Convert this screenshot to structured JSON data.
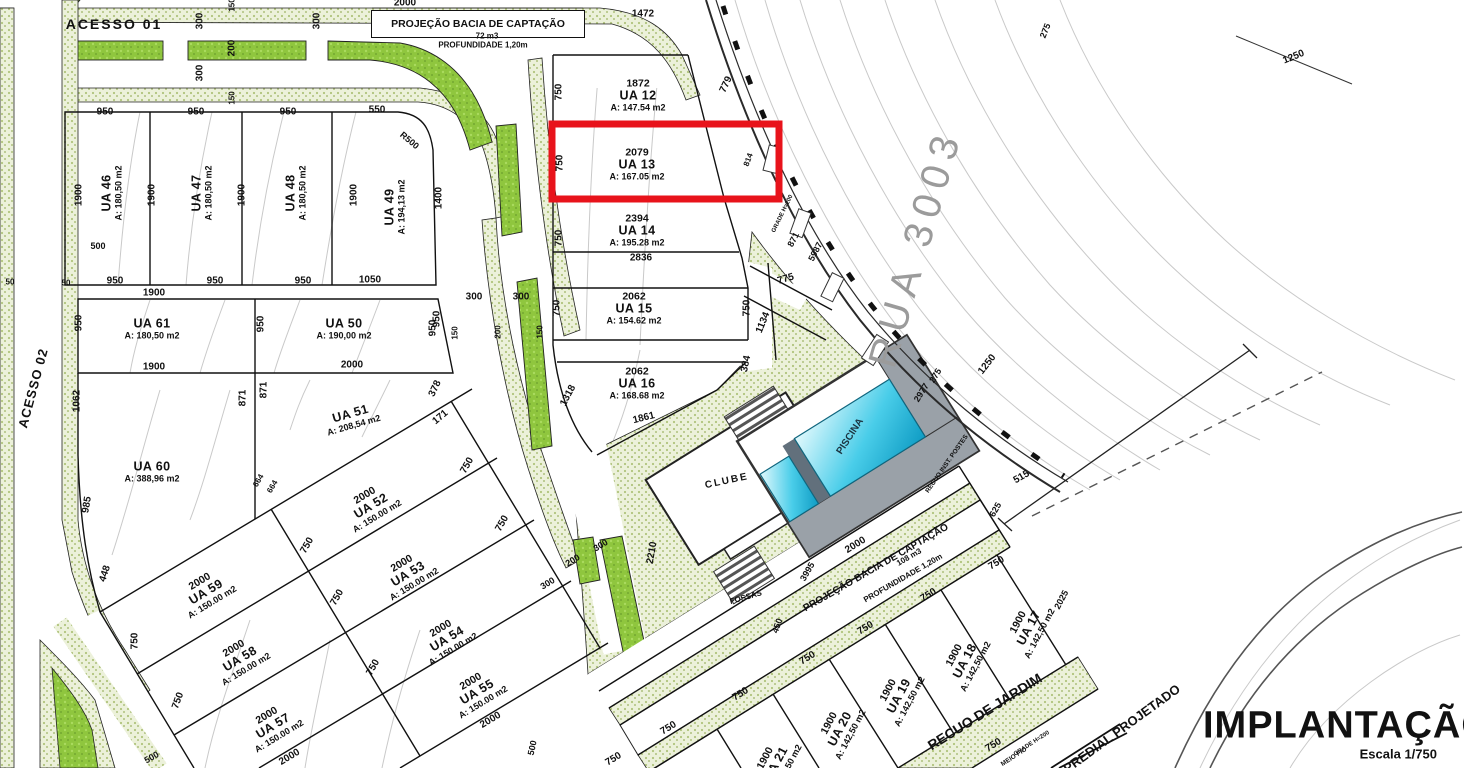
{
  "title": {
    "main": "IMPLANTAÇÃO",
    "scale": "Escala 1/750"
  },
  "roads": {
    "acesso1": "ACESSO 01",
    "acesso2": "ACESSO 02",
    "rua": "RUA 3003"
  },
  "basins": [
    {
      "title": "PROJEÇÃO BACIA DE CAPTAÇÃO",
      "volume": "72 m3",
      "depth": "PROFUNDIDADE 1,20m"
    },
    {
      "title": "PROJEÇÃO BACIA DE CAPTAÇÃO",
      "volume": "108 m3",
      "depth": "PROFUNDIDADE 1,20m"
    }
  ],
  "highlight": {
    "lot": "UA 13",
    "color": "#e8131b"
  },
  "colors": {
    "speckle_base": "#ecf1da",
    "speckle_dot": "#a9bf72",
    "island_green": "#8fc63e",
    "pool_light": "#e2f9fd",
    "pool_dark": "#0f9cc4",
    "deck_gray": "#9aa1a8",
    "contour": "#c9c9c9",
    "line": "#111111",
    "highlight": "#e8131b",
    "rua_text": "#9b9b9b"
  },
  "lots": [
    {
      "name": "UA 46",
      "area": "A: 180,50 m2",
      "x": 112,
      "y": 193,
      "r": -90
    },
    {
      "name": "UA 47",
      "area": "A: 180,50 m2",
      "x": 202,
      "y": 193,
      "r": -90
    },
    {
      "name": "UA 48",
      "area": "A: 180,50 m2",
      "x": 296,
      "y": 193,
      "r": -90
    },
    {
      "name": "UA 49",
      "area": "A: 194,13 m2",
      "x": 395,
      "y": 207,
      "r": -90
    },
    {
      "name": "UA 61",
      "area": "A: 180,50 m2",
      "x": 152,
      "y": 329,
      "r": 0
    },
    {
      "name": "UA 50",
      "area": "A: 190,00 m2",
      "x": 344,
      "y": 329,
      "r": 0
    },
    {
      "name": "UA 51",
      "area": "A: 208,54 m2",
      "x": 352,
      "y": 419,
      "r": -16
    },
    {
      "name": "UA 60",
      "area": "A: 388,96 m2",
      "x": 152,
      "y": 472,
      "r": 0
    },
    {
      "pre": "1872",
      "name": "UA 12",
      "area": "A: 147.54 m2",
      "x": 638,
      "y": 96,
      "r": 0
    },
    {
      "pre": "2079",
      "name": "UA 13",
      "area": "A: 167.05 m2",
      "x": 637,
      "y": 165,
      "r": 0
    },
    {
      "pre": "2394",
      "name": "UA 14",
      "area": "A: 195.28 m2",
      "x": 637,
      "y": 231,
      "r": 0
    },
    {
      "pre": "2062",
      "name": "UA 15",
      "area": "A: 154.62 m2",
      "x": 634,
      "y": 309,
      "r": 0
    },
    {
      "pre": "2062",
      "name": "UA 16",
      "area": "A: 168.68 m2",
      "x": 637,
      "y": 384,
      "r": 0
    },
    {
      "pre": "2000",
      "name": "UA 52",
      "area": "A: 150.00 m2",
      "x": 371,
      "y": 506,
      "r": -31
    },
    {
      "pre": "2000",
      "name": "UA 53",
      "area": "A: 150.00 m2",
      "x": 408,
      "y": 574,
      "r": -31
    },
    {
      "pre": "2000",
      "name": "UA 54",
      "area": "A: 150.00 m2",
      "x": 447,
      "y": 639,
      "r": -31
    },
    {
      "pre": "2000",
      "name": "UA 55",
      "area": "A: 150.00 m2",
      "x": 477,
      "y": 692,
      "r": -31
    },
    {
      "pre": "2000",
      "name": "UA 59",
      "area": "A: 150.00 m2",
      "x": 206,
      "y": 592,
      "r": -31
    },
    {
      "pre": "2000",
      "name": "UA 58",
      "area": "A: 150.00 m2",
      "x": 240,
      "y": 659,
      "r": -31
    },
    {
      "pre": "2000",
      "name": "UA 57",
      "area": "A: 150.00 m2",
      "x": 273,
      "y": 726,
      "r": -31
    },
    {
      "pre": "1900",
      "name": "UA 17",
      "area": "A: 142,50 m2",
      "x": 1029,
      "y": 628,
      "r": -62
    },
    {
      "pre": "1900",
      "name": "UA 18",
      "area": "A: 142,50 m2",
      "x": 965,
      "y": 661,
      "r": -62
    },
    {
      "pre": "1900",
      "name": "UA 19",
      "area": "A: 142,50 m2",
      "x": 899,
      "y": 696,
      "r": -62
    },
    {
      "pre": "1900",
      "name": "UA 20",
      "area": "A: 142,50 m2",
      "x": 840,
      "y": 729,
      "r": -62
    },
    {
      "pre": "1900",
      "name": "UA 21",
      "area": "A: 142,50 m2",
      "x": 776,
      "y": 764,
      "r": -62
    }
  ],
  "dims": [
    {
      "t": "2000",
      "x": 405,
      "y": 4,
      "r": 0
    },
    {
      "t": "150",
      "x": 233,
      "y": 5,
      "r": -90,
      "s": 8
    },
    {
      "t": "300",
      "x": 201,
      "y": 21,
      "r": -90
    },
    {
      "t": "200",
      "x": 233,
      "y": 48,
      "r": -90
    },
    {
      "t": "300",
      "x": 201,
      "y": 73,
      "r": -90
    },
    {
      "t": "150",
      "x": 233,
      "y": 98,
      "r": -90,
      "s": 8
    },
    {
      "t": "300",
      "x": 318,
      "y": 21,
      "r": -90
    },
    {
      "t": "1472",
      "x": 643,
      "y": 15,
      "r": 0
    },
    {
      "t": "950",
      "x": 105,
      "y": 113,
      "r": 0
    },
    {
      "t": "950",
      "x": 196,
      "y": 113,
      "r": 0
    },
    {
      "t": "950",
      "x": 288,
      "y": 113,
      "r": 0
    },
    {
      "t": "550",
      "x": 377,
      "y": 111,
      "r": 0
    },
    {
      "t": "1900",
      "x": 80,
      "y": 195,
      "r": -90
    },
    {
      "t": "1900",
      "x": 153,
      "y": 195,
      "r": -90
    },
    {
      "t": "1900",
      "x": 243,
      "y": 195,
      "r": -90
    },
    {
      "t": "1900",
      "x": 355,
      "y": 195,
      "r": -90
    },
    {
      "t": "1400",
      "x": 440,
      "y": 198,
      "r": -90
    },
    {
      "t": "500",
      "x": 98,
      "y": 247,
      "r": 0,
      "s": 9
    },
    {
      "t": "50",
      "x": 10,
      "y": 283,
      "r": 0,
      "s": 8
    },
    {
      "t": "50",
      "x": 66,
      "y": 284,
      "r": 0,
      "s": 8
    },
    {
      "t": "950",
      "x": 115,
      "y": 282,
      "r": 0
    },
    {
      "t": "950",
      "x": 215,
      "y": 282,
      "r": 0
    },
    {
      "t": "950",
      "x": 303,
      "y": 282,
      "r": 0
    },
    {
      "t": "1050",
      "x": 370,
      "y": 281,
      "r": 0
    },
    {
      "t": "1900",
      "x": 154,
      "y": 294,
      "r": 0
    },
    {
      "t": "950",
      "x": 80,
      "y": 323,
      "r": -90
    },
    {
      "t": "950",
      "x": 262,
      "y": 324,
      "r": -90
    },
    {
      "t": "950",
      "x": 434,
      "y": 328,
      "r": -90
    },
    {
      "t": "1900",
      "x": 154,
      "y": 368,
      "r": 0
    },
    {
      "t": "2000",
      "x": 352,
      "y": 366,
      "r": 0
    },
    {
      "t": "1062",
      "x": 78,
      "y": 401,
      "r": -90
    },
    {
      "t": "871",
      "x": 244,
      "y": 398,
      "r": -90
    },
    {
      "t": "871",
      "x": 265,
      "y": 390,
      "r": -90
    },
    {
      "t": "378",
      "x": 436,
      "y": 389,
      "r": -65
    },
    {
      "t": "171",
      "x": 441,
      "y": 418,
      "r": -40
    },
    {
      "t": "985",
      "x": 88,
      "y": 505,
      "r": -80
    },
    {
      "t": "448",
      "x": 106,
      "y": 574,
      "r": -72
    },
    {
      "t": "664",
      "x": 259,
      "y": 481,
      "r": -60,
      "s": 8
    },
    {
      "t": "664",
      "x": 273,
      "y": 487,
      "r": -60,
      "s": 8
    },
    {
      "t": "750",
      "x": 560,
      "y": 92,
      "r": -90
    },
    {
      "t": "750",
      "x": 561,
      "y": 163,
      "r": -90
    },
    {
      "t": "750",
      "x": 560,
      "y": 238,
      "r": -90
    },
    {
      "t": "750",
      "x": 558,
      "y": 308,
      "r": -90
    },
    {
      "t": "750",
      "x": 748,
      "y": 308,
      "r": -90
    },
    {
      "t": "2836",
      "x": 641,
      "y": 259,
      "r": 0
    },
    {
      "t": "775",
      "x": 786,
      "y": 280,
      "r": -16
    },
    {
      "t": "1134",
      "x": 764,
      "y": 323,
      "r": -68
    },
    {
      "t": "384",
      "x": 747,
      "y": 364,
      "r": -78
    },
    {
      "t": "1318",
      "x": 569,
      "y": 396,
      "r": -62
    },
    {
      "t": "1861",
      "x": 644,
      "y": 419,
      "r": -14
    },
    {
      "t": "779",
      "x": 727,
      "y": 85,
      "r": -65
    },
    {
      "t": "814",
      "x": 749,
      "y": 160,
      "r": -70,
      "s": 8
    },
    {
      "t": "871",
      "x": 794,
      "y": 240,
      "r": -62,
      "s": 9
    },
    {
      "t": "5987",
      "x": 816,
      "y": 252,
      "r": -62,
      "s": 9
    },
    {
      "t": "2977",
      "x": 922,
      "y": 393,
      "r": -58,
      "s": 9
    },
    {
      "t": "275",
      "x": 936,
      "y": 376,
      "r": -58,
      "s": 9
    },
    {
      "t": "1250",
      "x": 988,
      "y": 365,
      "r": -52
    },
    {
      "t": "275",
      "x": 1046,
      "y": 31,
      "r": -68,
      "s": 9
    },
    {
      "t": "1250",
      "x": 1294,
      "y": 58,
      "r": -22
    },
    {
      "t": "515",
      "x": 1022,
      "y": 478,
      "r": -30
    },
    {
      "t": "625",
      "x": 996,
      "y": 510,
      "r": -60,
      "s": 9
    },
    {
      "t": "2025",
      "x": 1062,
      "y": 600,
      "r": -62,
      "s": 9
    },
    {
      "t": "2000",
      "x": 856,
      "y": 546,
      "r": -32
    },
    {
      "t": "3995",
      "x": 808,
      "y": 572,
      "r": -60,
      "s": 9
    },
    {
      "t": "450",
      "x": 778,
      "y": 626,
      "r": -70,
      "s": 9
    },
    {
      "t": "300",
      "x": 548,
      "y": 584,
      "r": -32,
      "s": 9
    },
    {
      "t": "200",
      "x": 573,
      "y": 561,
      "r": -32,
      "s": 9
    },
    {
      "t": "300",
      "x": 601,
      "y": 546,
      "r": -32,
      "s": 9
    },
    {
      "t": "2210",
      "x": 653,
      "y": 553,
      "r": -80
    },
    {
      "t": "300",
      "x": 474,
      "y": 298,
      "r": 0
    },
    {
      "t": "300",
      "x": 521,
      "y": 298,
      "r": 0
    },
    {
      "t": "150",
      "x": 456,
      "y": 333,
      "r": -90,
      "s": 8
    },
    {
      "t": "200",
      "x": 499,
      "y": 332,
      "r": -90,
      "s": 8
    },
    {
      "t": "150",
      "x": 541,
      "y": 332,
      "r": -90,
      "s": 8
    },
    {
      "t": "950",
      "x": 438,
      "y": 319,
      "r": -90
    },
    {
      "t": "750",
      "x": 468,
      "y": 466,
      "r": -60
    },
    {
      "t": "750",
      "x": 503,
      "y": 524,
      "r": -60
    },
    {
      "t": "750",
      "x": 308,
      "y": 546,
      "r": -60
    },
    {
      "t": "750",
      "x": 338,
      "y": 598,
      "r": -60
    },
    {
      "t": "750",
      "x": 136,
      "y": 641,
      "r": -90
    },
    {
      "t": "750",
      "x": 179,
      "y": 701,
      "r": -70
    },
    {
      "t": "750",
      "x": 374,
      "y": 668,
      "r": -60
    },
    {
      "t": "500",
      "x": 152,
      "y": 758,
      "r": -30,
      "s": 9
    },
    {
      "t": "500",
      "x": 533,
      "y": 748,
      "r": -78,
      "s": 9
    },
    {
      "t": "750",
      "x": 997,
      "y": 564,
      "r": -32
    },
    {
      "t": "750",
      "x": 929,
      "y": 596,
      "r": -32
    },
    {
      "t": "750",
      "x": 866,
      "y": 629,
      "r": -32
    },
    {
      "t": "750",
      "x": 808,
      "y": 659,
      "r": -32
    },
    {
      "t": "750",
      "x": 741,
      "y": 695,
      "r": -32
    },
    {
      "t": "750",
      "x": 669,
      "y": 729,
      "r": -32
    },
    {
      "t": "750",
      "x": 614,
      "y": 760,
      "r": -32
    },
    {
      "t": "750",
      "x": 994,
      "y": 746,
      "r": -32
    },
    {
      "t": "2000",
      "x": 290,
      "y": 758,
      "r": -31
    },
    {
      "t": "2000",
      "x": 491,
      "y": 721,
      "r": -31
    }
  ],
  "notes": [
    {
      "n": "clube-label",
      "t": "CLUBE",
      "x": 727,
      "y": 482,
      "r": -12,
      "s": 10,
      "ls": 2
    },
    {
      "n": "piscina-label",
      "t": "PISCINA",
      "x": 851,
      "y": 437,
      "r": -57,
      "s": 10,
      "c": "#1b3440"
    },
    {
      "n": "fossas-label",
      "t": "FOSSAS",
      "x": 746,
      "y": 598,
      "r": -16,
      "s": 8
    },
    {
      "n": "recuo-jardim-label",
      "t": "RECUO DE JARDIM",
      "x": 985,
      "y": 712,
      "r": -32,
      "s": 14
    },
    {
      "n": "recuo-postes-label",
      "t": "RECUO INST. POSTES",
      "x": 947,
      "y": 464,
      "r": -55,
      "s": 6.5
    },
    {
      "n": "meio-fio-label",
      "t": "MEIO FIO",
      "x": 1014,
      "y": 757,
      "r": -33,
      "s": 6.5
    },
    {
      "n": "grade-label-1",
      "t": "GRADE H=200",
      "x": 1032,
      "y": 744,
      "r": -33,
      "s": 6
    },
    {
      "n": "grade-label-2",
      "t": "GRADE H=200",
      "x": 783,
      "y": 214,
      "r": -64,
      "s": 6
    },
    {
      "n": "predial-projetado-label",
      "t": "PREDIAL PROJETADO",
      "x": 1122,
      "y": 729,
      "r": -36,
      "s": 13
    },
    {
      "n": "r500-label",
      "t": "R500",
      "x": 409,
      "y": 141,
      "r": 40,
      "s": 9
    }
  ]
}
